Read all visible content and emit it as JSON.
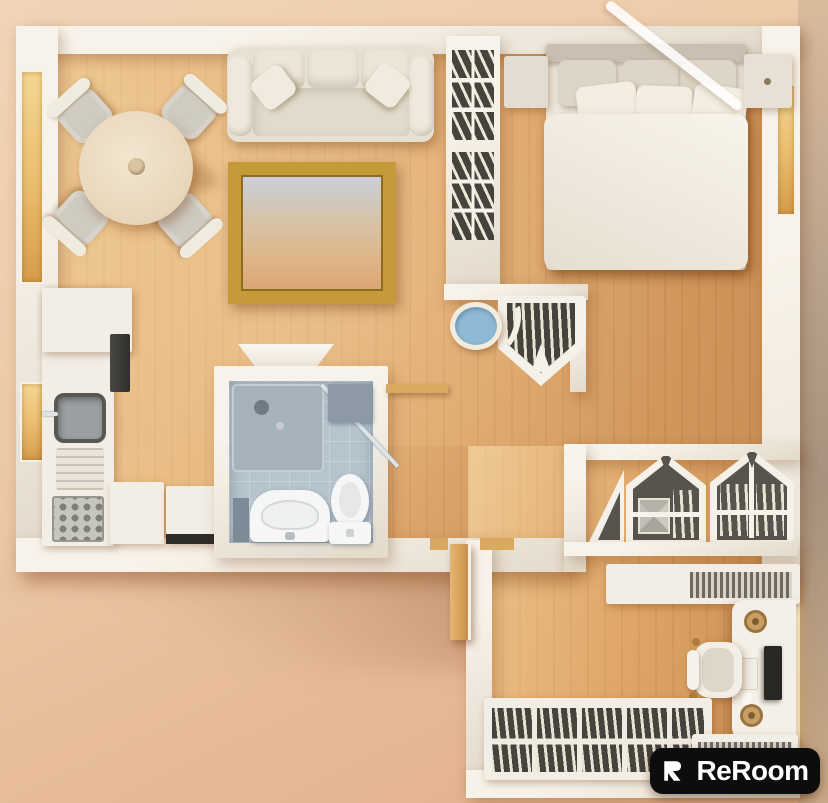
{
  "watermark": {
    "brand": "ReRoom",
    "icon": "reroom-logo-mark"
  },
  "palette": {
    "wall": "#f8f3ea",
    "wall_shade": "#e3dacb",
    "floor_dark": "#d79f63",
    "window_wood": "#e9bd6e",
    "bathroom_floor": "#b6c4cd",
    "shower_tray": "#a5b2bb",
    "stool_blue": "#8fb9d6",
    "frame_gold": "#c59a38",
    "shelf_dark": "#46423c",
    "logo_bg": "#0d0d0d",
    "logo_fg": "#ffffff"
  },
  "scene": {
    "type": "3d-top-down-floor-plan-render",
    "rooms": [
      {
        "name": "living-room",
        "furniture": [
          "white-sofa-with-pillows",
          "round-dining-table",
          "four-dining-chairs",
          "gold-framed-sky-picture",
          "wall-console"
        ]
      },
      {
        "name": "kitchen",
        "furniture": [
          "counter",
          "oven",
          "sink",
          "drainboard",
          "stove-top",
          "two-appliance-cabinets"
        ]
      },
      {
        "name": "bathroom",
        "furniture": [
          "corner-shower",
          "vanity-sink",
          "toilet",
          "cabinet"
        ]
      },
      {
        "name": "bedroom",
        "furniture": [
          "double-bed-six-pillows",
          "two-nightstands",
          "tall-bookshelf-divider",
          "pentagon-wall-shelf",
          "blue-round-stool"
        ]
      },
      {
        "name": "office",
        "furniture": [
          "desk-with-monitor",
          "office-chair",
          "house-shaped-wall-shelves",
          "record-shelf",
          "low-bookshelf",
          "wooden-door"
        ]
      }
    ]
  }
}
